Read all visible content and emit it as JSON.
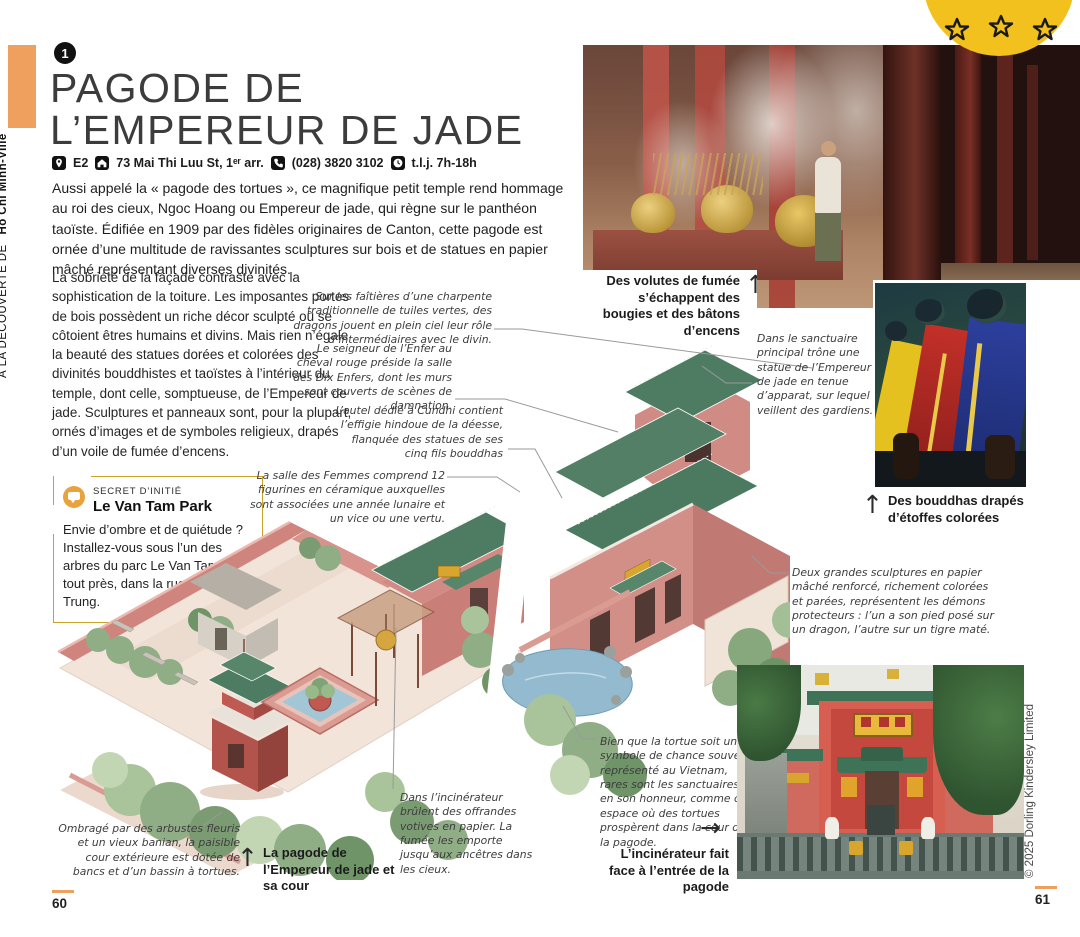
{
  "page": {
    "left_number": "60",
    "right_number": "61",
    "copyright": "© 2025 Dorling Kindersley Limited"
  },
  "sidebar": {
    "section": "À LA DÉCOUVERTE DE",
    "chapter": "Hô Chi Minh-Ville"
  },
  "rating": {
    "stars": 3
  },
  "header": {
    "index_number": "1",
    "title_line1": "PAGODE DE",
    "title_line2": "L’EMPEREUR DE JADE",
    "info": {
      "map_ref": "E2",
      "address": "73 Mai Thi Luu St, 1ᵉʳ arr.",
      "phone": "(028) 3820 3102",
      "hours": "t.l.j. 7h-18h"
    }
  },
  "intro": "Aussi appelé la « pagode des tortues », ce magnifique petit temple rend hommage au roi des cieux, Ngoc Hoang ou Empereur de jade, qui règne sur le panthéon taoïste. Édifiée en 1909 par des fidèles originaires de Canton, cette pagode est ornée d’une multitude de ravissantes sculptures sur bois et de statues en papier mâché représentant diverses divinités.",
  "body": "La sobriété de la façade contraste avec la sophistication de la toiture. Les imposantes portes de bois possèdent un riche décor sculpté où se côtoient êtres humains et divins. Mais rien n’égale la beauté des statues dorées et colorées des divinités bouddhistes et taoïstes à l’intérieur du temple, dont celle, somptueuse, de l’Empereur de jade. Sculptures et panneaux sont, pour la plupart, ornés d’images et de symboles religieux, drapés d’un voile de fumée d’encens.",
  "secret_box": {
    "kicker": "SECRET D’INITIÉ",
    "title": "Le Van Tam Park",
    "text": "Envie d’ombre et de quiétude ? Installez-vous sous l’un des arbres du parc Le Van Tam, situé tout près, dans la rue Hai Ba Trung."
  },
  "annotations": {
    "faitieres": "Sur les faîtières d’une charpente traditionnelle de tuiles vertes, des dragons jouent en plein ciel leur rôle d’intermédiaires avec le divin.",
    "enfers": "Le seigneur de l’Enfer au cheval rouge préside la salle des Dix Enfers, dont les murs sont couverts de scènes de damnation.",
    "cundhi": "L’autel dédié à Cundhi contient l’effigie hindoue de la déesse, flanquée des statues de ses cinq fils bouddhas",
    "femmes": "La salle des Femmes comprend 12 figurines en céramique auxquelles sont associées une année lunaire et un vice ou une vertu.",
    "sanctuaire": "Dans le sanctuaire principal trône une statue de l’Empereur de jade en tenue d’apparat, sur lequel veillent des gardiens.",
    "demons": "Deux grandes sculptures en papier mâché renforcé, richement colorées et parées, représentent les démons protecteurs : l’un a son pied posé sur un dragon, l’autre sur un tigre maté.",
    "tortue": "Bien que la tortue soit un symbole de chance souvent représenté au Vietnam, rares sont les sanctuaires en son honneur, comme cet espace où des tortues prospèrent dans la cour de la pagode.",
    "incinerateur": "Dans l’incinérateur brûlent des offrandes votives en papier. La fumée les emporte jusqu’aux ancêtres dans les cieux.",
    "cour": "Ombragé par des arbustes fleuris et un vieux banian, la paisible cour extérieure est dotée de bancs et d’un bassin à tortues."
  },
  "captions": {
    "volutes": "Des volutes de fumée s’échappent des bougies et des bâtons d’encens",
    "bouddhas": "Des bouddhas drapés d’étoffes colorées",
    "pagode_cour": "La pagode de l’Empereur de jade et sa cour",
    "incinerateur_face": "L’incinérateur fait face à l’entrée de la pagode"
  },
  "icons": {
    "up_arrow": "↑",
    "right_arrow": "→"
  },
  "colors": {
    "accent_orange": "#EFA05E",
    "gold_frame": "#C9A227",
    "badge_yellow": "#F2C11D",
    "icon_orange": "#E8A33D"
  }
}
